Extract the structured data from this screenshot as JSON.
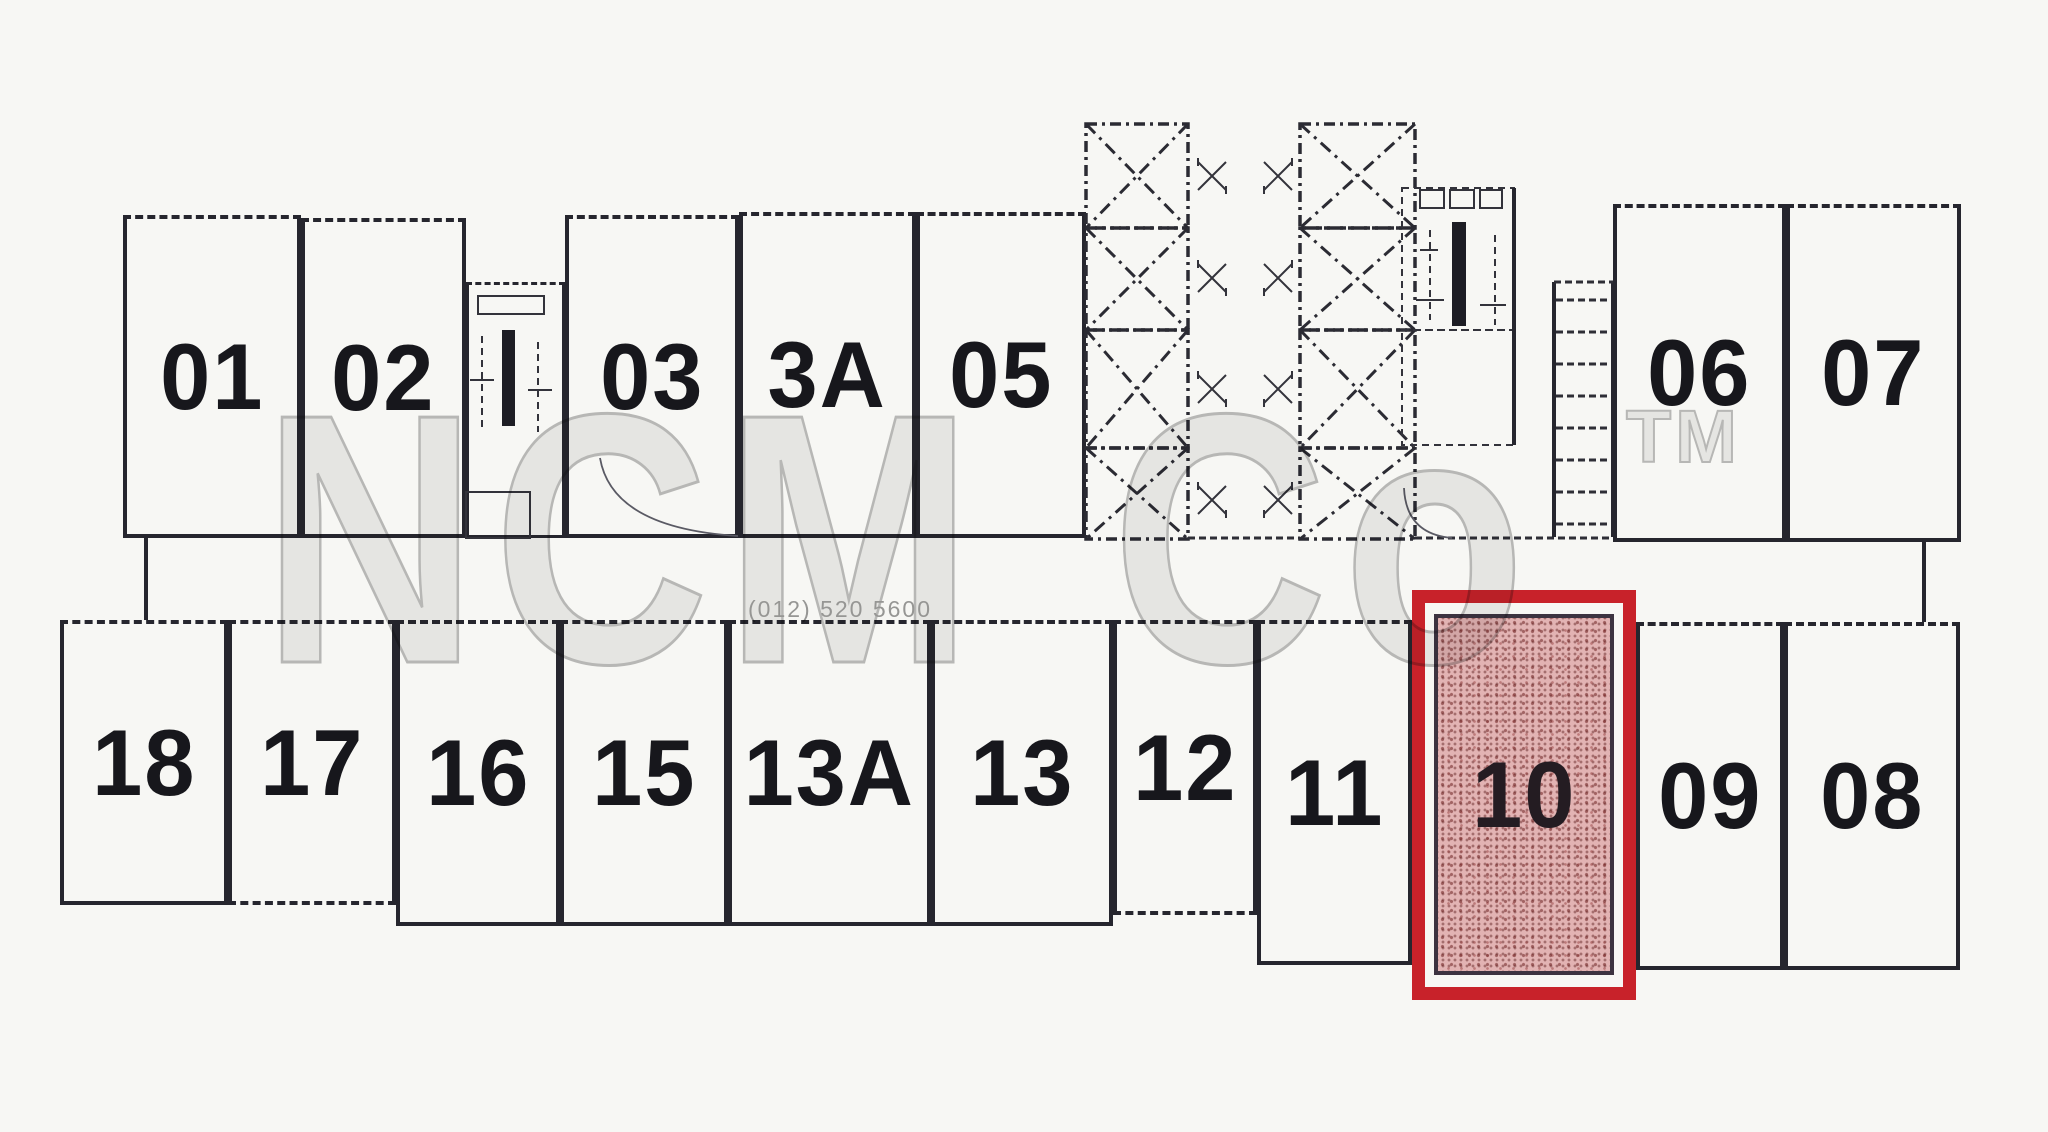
{
  "units": {
    "top": [
      {
        "id": "01",
        "label": "01"
      },
      {
        "id": "02",
        "label": "02"
      },
      {
        "id": "03",
        "label": "03"
      },
      {
        "id": "3A",
        "label": "3A"
      },
      {
        "id": "05",
        "label": "05"
      },
      {
        "id": "06",
        "label": "06"
      },
      {
        "id": "07",
        "label": "07"
      }
    ],
    "bottom": [
      {
        "id": "18",
        "label": "18"
      },
      {
        "id": "17",
        "label": "17"
      },
      {
        "id": "16",
        "label": "16"
      },
      {
        "id": "15",
        "label": "15"
      },
      {
        "id": "13A",
        "label": "13A"
      },
      {
        "id": "13",
        "label": "13"
      },
      {
        "id": "12",
        "label": "12"
      },
      {
        "id": "11",
        "label": "11"
      },
      {
        "id": "09",
        "label": "09"
      },
      {
        "id": "08",
        "label": "08"
      }
    ]
  },
  "highlight": {
    "unit_label": "10",
    "border_color": "#c8222a",
    "fill_color": "#e2b3b3"
  },
  "watermark": {
    "brand": "NCM Co",
    "tm": "TM",
    "phone": "(012) 520 5600"
  },
  "colors": {
    "wall": "#26262e",
    "paper": "#f7f7f4",
    "watermark_gray": "#bdbdbd"
  }
}
